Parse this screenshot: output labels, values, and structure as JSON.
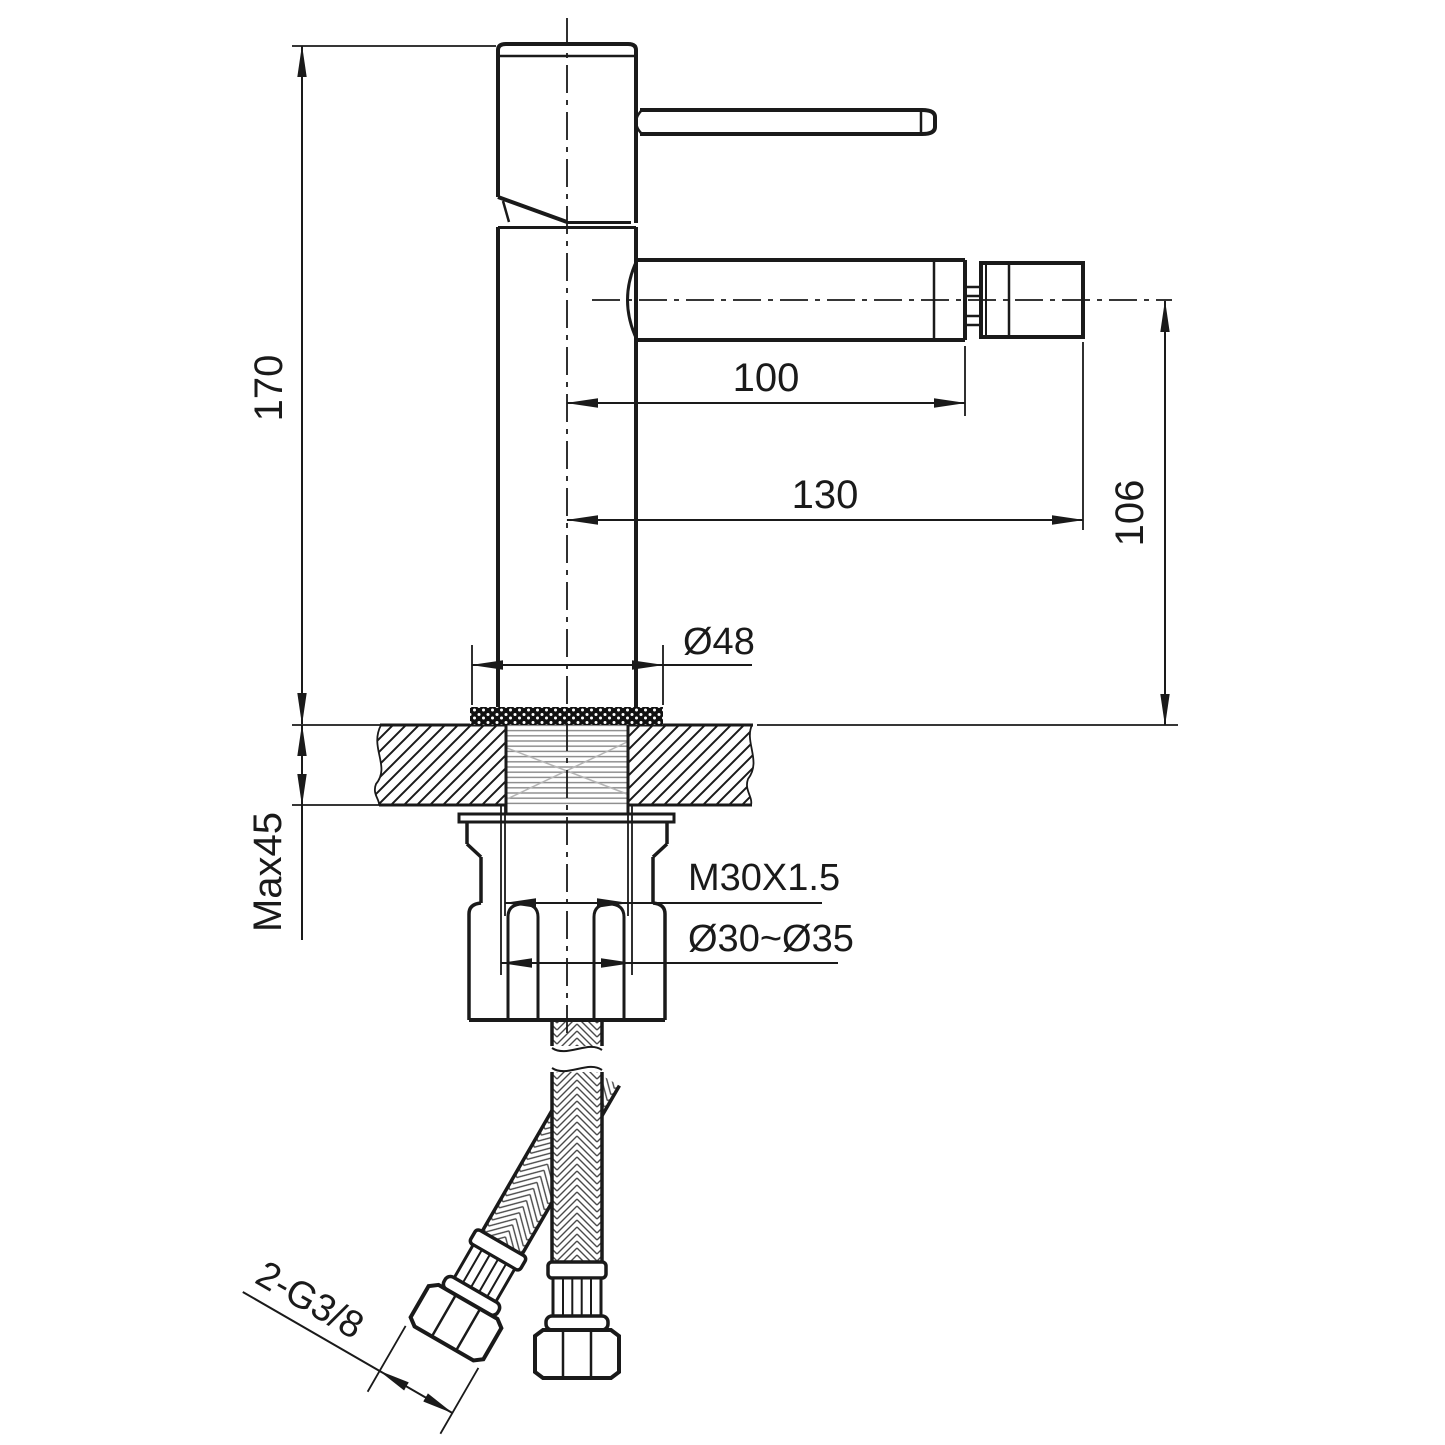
{
  "drawing": {
    "type": "faucet installation dimension drawing",
    "dims": {
      "body_height": "170",
      "spout_reach": "100",
      "total_reach": "130",
      "spout_axis_height": "106",
      "base_diameter": "Ø48",
      "max_deck_thickness": "Max45",
      "shank_thread": "M30X1.5",
      "hole_diameter_range": "Ø30~Ø35",
      "hose_connections": "2-G3/8"
    },
    "colors": {
      "line": "#1a1a1a",
      "background": "#ffffff"
    }
  }
}
